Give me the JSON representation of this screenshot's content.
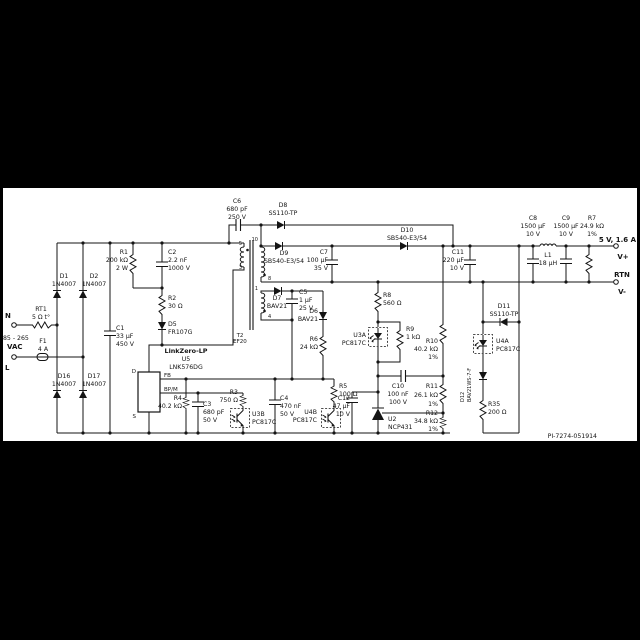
{
  "doc_id": "PI-7274-051914",
  "input": {
    "n": "N",
    "l": "L",
    "range": "85 - 265",
    "unit": "VAC"
  },
  "output": {
    "rating": "5 V, 1.6 A",
    "vplus": "V+",
    "rtn": "RTN",
    "vminus": "V-"
  },
  "ic": {
    "name": "LinkZero-LP",
    "ref": "U5",
    "part": "LNK576DG",
    "pin_d": "D",
    "pin_s": "S",
    "pin_fb": "FB",
    "pin_bpm": "BP/M"
  },
  "transformer": {
    "ref": "T2",
    "core": "EF20",
    "pins": {
      "p5": "5",
      "p3": "3",
      "p10": "10",
      "p8": "8",
      "p1": "1",
      "p4": "4"
    }
  },
  "c": {
    "rt1": [
      "RT1",
      "5 Ω t°"
    ],
    "f1": [
      "F1",
      "4 A"
    ],
    "d1": [
      "D1",
      "1N4007"
    ],
    "d2": [
      "D2",
      "1N4007"
    ],
    "d16": [
      "D16",
      "1N4007"
    ],
    "d17": [
      "D17",
      "1N4007"
    ],
    "c1": [
      "C1",
      "33 µF",
      "450 V"
    ],
    "r1": [
      "R1",
      "200 kΩ",
      "2 W"
    ],
    "c2": [
      "C2",
      "2.2 nF",
      "1000 V"
    ],
    "r2": [
      "R2",
      "30 Ω"
    ],
    "d5": [
      "D5",
      "FR107G"
    ],
    "r4": [
      "R4",
      "40.2 kΩ"
    ],
    "c3": [
      "C3",
      "680 pF",
      "50 V"
    ],
    "r3": [
      "R3",
      "750 Ω"
    ],
    "u3b": [
      "U3B",
      "PC817C"
    ],
    "c4": [
      "C4",
      "470 nF",
      "50 V"
    ],
    "u4b": [
      "U4B",
      "PC817C"
    ],
    "r5": [
      "R5",
      "100 Ω"
    ],
    "c12": [
      "C12",
      "47 µF",
      "10 V"
    ],
    "c6": [
      "C6",
      "680 pF",
      "250 V"
    ],
    "d8": [
      "D8",
      "SS110-TP"
    ],
    "d9": [
      "D9",
      "SB540-E3/54"
    ],
    "c7": [
      "C7",
      "100 µF",
      "35 V"
    ],
    "d7": [
      "D7",
      "BAV21"
    ],
    "c5": [
      "C5",
      "1 µF",
      "25 V"
    ],
    "d6": [
      "D6",
      "BAV21"
    ],
    "r6": [
      "R6",
      "24 kΩ"
    ],
    "d10": [
      "D10",
      "SB540-E3/54"
    ],
    "c11": [
      "C11",
      "220 µF",
      "10 V"
    ],
    "r8": [
      "R8",
      "560 Ω"
    ],
    "u3a": [
      "U3A",
      "PC817C"
    ],
    "r9": [
      "R9",
      "1 kΩ"
    ],
    "r10": [
      "R10",
      "40.2 kΩ",
      "1%"
    ],
    "c10": [
      "C10",
      "100 nF",
      "100 V"
    ],
    "r11": [
      "R11",
      "26.1 kΩ",
      "1%"
    ],
    "u2": [
      "U2",
      "NCP431"
    ],
    "r12": [
      "R12",
      "34.8 kΩ",
      "1%"
    ],
    "d11": [
      "D11",
      "SS110-TP"
    ],
    "u4a": [
      "U4A",
      "PC817C"
    ],
    "d12": [
      "D12",
      "BAV21WS-7-F"
    ],
    "r35": [
      "R35",
      "200 Ω"
    ],
    "c8": [
      "C8",
      "1500 µF",
      "10 V"
    ],
    "l1": [
      "L1",
      "18 µH"
    ],
    "c9": [
      "C9",
      "1500 µF",
      "10 V"
    ],
    "r7": [
      "R7",
      "24.9 kΩ",
      "1%"
    ]
  }
}
